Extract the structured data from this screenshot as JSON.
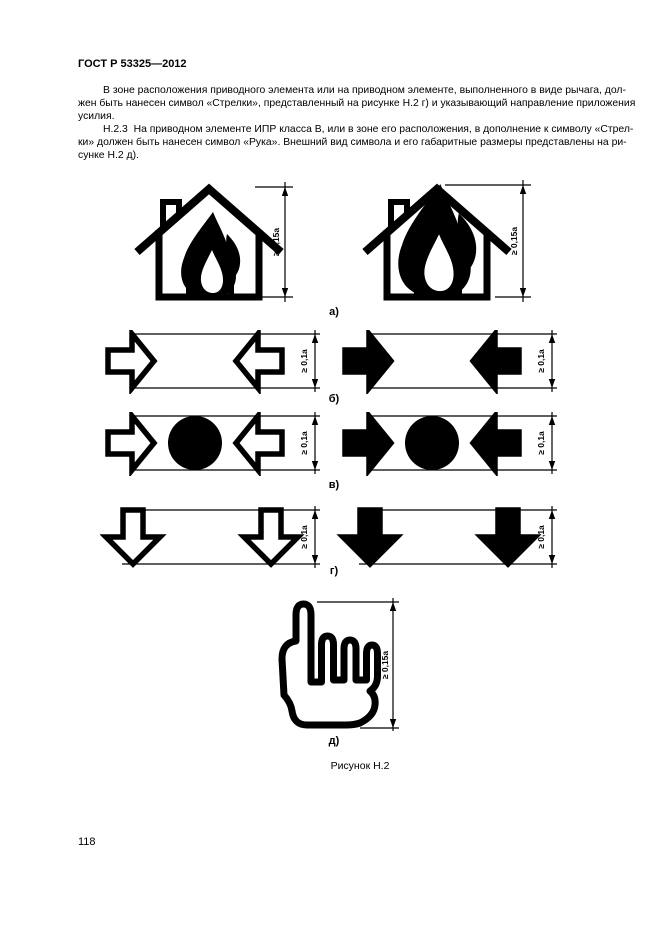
{
  "document": {
    "header": "ГОСТ Р 53325—2012",
    "page_number": "118",
    "body_lines": [
      "В зоне расположения приводного элемента или на приводном элементе, выполненного в виде рычага, дол-",
      "жен быть нанесен символ «Стрелки», представленный на рисунке Н.2 г) и указывающий направление приложения",
      "усилия.",
      "Н.2.3  На приводном элементе ИПР класса В, или в зоне его расположения, в дополнение к символу «Стрел-",
      "ки» должен быть нанесен символ «Рука». Внешний вид символа и его габаритные размеры представлены на ри-",
      "сунке Н.2 д)."
    ],
    "figure": {
      "caption": "Рисунок Н.2",
      "labels": [
        "а)",
        "б)",
        "в)",
        "г)",
        "д)"
      ],
      "dimensions": {
        "house_height": "≥ 0,15a",
        "arrow_size": "≥ 0,1a",
        "hand_height": "≥ 0,15a"
      }
    }
  }
}
